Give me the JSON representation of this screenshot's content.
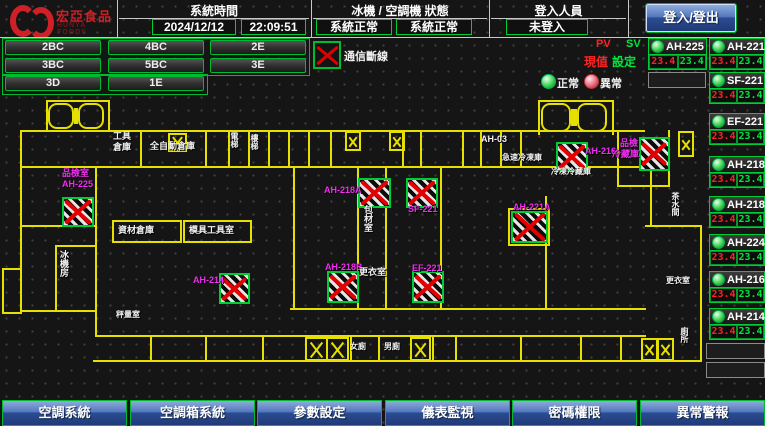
{
  "header": {
    "brand": {
      "name": "宏亞食品",
      "name_en": "HUNYA FOODS"
    },
    "sections": [
      {
        "label": "系統時間",
        "values": [
          "2024/12/12",
          "22:09:51"
        ]
      },
      {
        "label": "冰機 / 空調機 狀態",
        "values": [
          "系統正常",
          "系統正常"
        ]
      },
      {
        "label": "登入人員",
        "values": [
          "未登入"
        ]
      }
    ],
    "login_button": "登入/登出"
  },
  "floor_buttons": [
    [
      "2BC",
      "4BC",
      "2E"
    ],
    [
      "3BC",
      "5BC",
      "3E"
    ],
    [
      "3D",
      "1E"
    ]
  ],
  "legend": {
    "comm_loss": "通信斷線",
    "pv": "PV",
    "sv": "SV",
    "pv_label": "現值",
    "sv_label": "設定",
    "normal": "正常",
    "abnormal": "異常",
    "accent_green": "#00cc33",
    "accent_red": "#e40000",
    "accent_magenta": "#f32df3",
    "accent_yellow": "#e6e000"
  },
  "units": [
    {
      "name": "AH-225",
      "pv": "23.4",
      "sv": "23.4"
    },
    {
      "name": "AH-221A",
      "pv": "23.4",
      "sv": "23.4"
    },
    {
      "name": "SF-221",
      "pv": "23.4",
      "sv": "23.4"
    },
    {
      "name": "EF-221",
      "pv": "23.4",
      "sv": "23.4"
    },
    {
      "name": "AH-218A",
      "pv": "23.4",
      "sv": "23.4"
    },
    {
      "name": "AH-218B",
      "pv": "23.4",
      "sv": "23.4"
    },
    {
      "name": "AH-224",
      "pv": "23.4",
      "sv": "23.4"
    },
    {
      "name": "AH-216",
      "pv": "23.4",
      "sv": "23.4"
    },
    {
      "name": "AH-214",
      "pv": "23.4",
      "sv": "23.4"
    }
  ],
  "map": {
    "fans": [
      {
        "unit": "AH-225",
        "x": 62,
        "y": 197,
        "w": 28,
        "h": 26
      },
      {
        "unit": "AH-218A",
        "x": 358,
        "y": 178,
        "w": 29,
        "h": 26
      },
      {
        "unit": "SF-221",
        "x": 406,
        "y": 178,
        "w": 28,
        "h": 26
      },
      {
        "unit": "AH-216",
        "x": 556,
        "y": 142,
        "w": 28,
        "h": 26
      },
      {
        "unit": "冷藏庫",
        "x": 639,
        "y": 137,
        "w": 27,
        "h": 30
      },
      {
        "unit": "AH-221A",
        "x": 511,
        "y": 211,
        "w": 33,
        "h": 28
      },
      {
        "unit": "AH-218B",
        "x": 327,
        "y": 271,
        "w": 28,
        "h": 28
      },
      {
        "unit": "EF-221",
        "x": 412,
        "y": 271,
        "w": 28,
        "h": 28
      },
      {
        "unit": "AH-214",
        "x": 219,
        "y": 273,
        "w": 27,
        "h": 27
      }
    ],
    "labels": [
      {
        "text": "品檢室",
        "x": 62,
        "y": 168,
        "color": "m"
      },
      {
        "text": "AH-225",
        "x": 62,
        "y": 179,
        "color": "m"
      },
      {
        "text": "AH-218A",
        "x": 324,
        "y": 185,
        "color": "m"
      },
      {
        "text": "SF-221",
        "x": 408,
        "y": 204,
        "color": "m"
      },
      {
        "text": "AH-216",
        "x": 585,
        "y": 146,
        "color": "m"
      },
      {
        "text": "品檢",
        "x": 620,
        "y": 138,
        "color": "m"
      },
      {
        "text": "冷藏庫",
        "x": 612,
        "y": 149,
        "color": "m"
      },
      {
        "text": "AH-221A",
        "x": 513,
        "y": 202,
        "color": "m"
      },
      {
        "text": "AH-218B",
        "x": 325,
        "y": 262,
        "color": "m"
      },
      {
        "text": "EF-221",
        "x": 412,
        "y": 263,
        "color": "m"
      },
      {
        "text": "AH-214",
        "x": 193,
        "y": 275,
        "color": "m"
      },
      {
        "text": "工具",
        "x": 113,
        "y": 131,
        "color": "w"
      },
      {
        "text": "倉庫",
        "x": 113,
        "y": 142,
        "color": "w"
      },
      {
        "text": "全自動倉庫",
        "x": 150,
        "y": 141,
        "color": "w"
      },
      {
        "text": "電梯",
        "x": 230,
        "y": 132,
        "color": "w",
        "vert": true,
        "size": 8
      },
      {
        "text": "樓梯",
        "x": 250,
        "y": 134,
        "color": "w",
        "vert": true,
        "size": 8
      },
      {
        "text": "AH-03",
        "x": 481,
        "y": 134,
        "color": "w"
      },
      {
        "text": "急速冷凍庫",
        "x": 502,
        "y": 153,
        "color": "w",
        "size": 8
      },
      {
        "text": "冷凍冷藏庫",
        "x": 551,
        "y": 167,
        "color": "w",
        "size": 8
      },
      {
        "text": "包材室",
        "x": 363,
        "y": 205,
        "color": "w",
        "vert": true
      },
      {
        "text": "更衣室",
        "x": 359,
        "y": 267,
        "color": "w"
      },
      {
        "text": "資材倉庫",
        "x": 118,
        "y": 225,
        "color": "w"
      },
      {
        "text": "模具工具室",
        "x": 189,
        "y": 225,
        "color": "w"
      },
      {
        "text": "冰機房",
        "x": 59,
        "y": 250,
        "color": "w",
        "vert": true
      },
      {
        "text": "秤量室",
        "x": 116,
        "y": 310,
        "color": "w",
        "size": 8
      },
      {
        "text": "女廁",
        "x": 350,
        "y": 342,
        "color": "w",
        "size": 8
      },
      {
        "text": "男廁",
        "x": 384,
        "y": 342,
        "color": "w",
        "size": 8
      },
      {
        "text": "茶水間",
        "x": 671,
        "y": 192,
        "color": "w",
        "vert": true,
        "size": 8
      },
      {
        "text": "更衣室",
        "x": 666,
        "y": 276,
        "color": "w",
        "size": 8
      },
      {
        "text": "廁所",
        "x": 680,
        "y": 327,
        "color": "w",
        "vert": true,
        "size": 8
      }
    ]
  },
  "footer_buttons": [
    "空調系統",
    "空調箱系統",
    "參數設定",
    "儀表監視",
    "密碼權限",
    "異常警報"
  ]
}
